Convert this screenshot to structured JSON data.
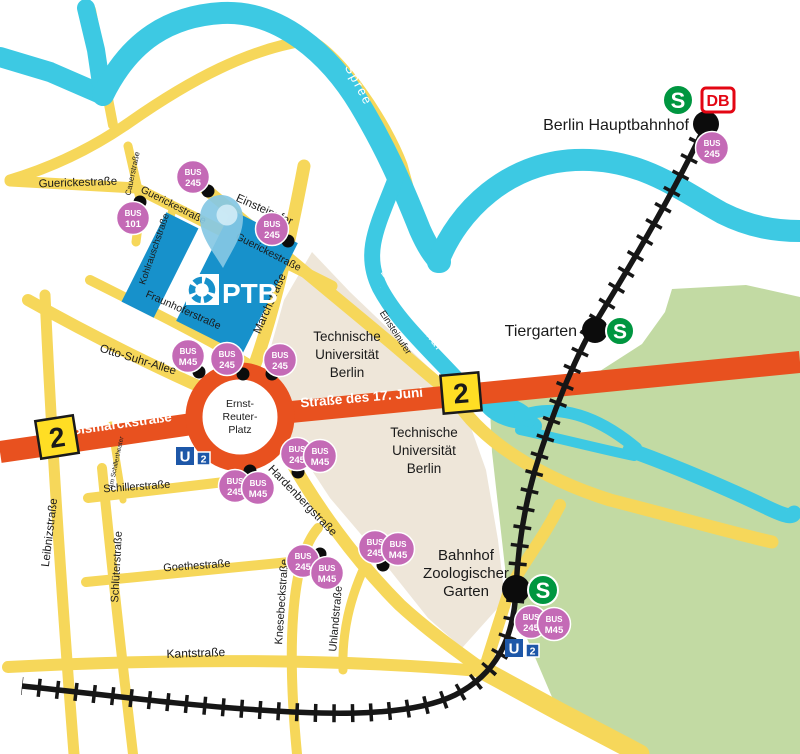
{
  "map_title": "PTB Berlin Ernst-Reuter-Platz area map",
  "colors": {
    "water": "#3DC9E3",
    "street_yellow": "#F6D75A",
    "u2_road_orange": "#E8511F",
    "park_green": "#C2DAA3",
    "campus_beige": "#EEE6D9",
    "ptb_building_blue": "#1791CB",
    "pin_blue": "#85C8E4",
    "bus_badge_magenta": "#C46AB6",
    "sbahn_green": "#009640",
    "ubahn_blue": "#1D57A8",
    "db_red": "#E30613",
    "road_badge_yellow": "#FFDE24",
    "railway_black": "#161616"
  },
  "streets": {
    "guericke": "Guerickestraße",
    "cauer": "Cauerstraße",
    "einsteinufer": "Einsteinufer",
    "kohlrausch": "Kohlrauschstraße",
    "fraunhofer": "Fraunhoferstraße",
    "march": "Marchstraße",
    "otto_suhr": "Otto-Suhr-Allee",
    "bismarck": "Bismarckstraße",
    "str17juni": "Straße des 17. Juni",
    "leibniz": "Leibnizstraße",
    "am_schillertheater": "Am Schillertheater",
    "schiller": "Schillerstraße",
    "schlueter": "Schlüterstraße",
    "goethe": "Goethestraße",
    "knesebeck": "Knesebeckstraße",
    "uhland": "Uhlandstraße",
    "kant": "Kantstraße",
    "hardenberg": "Hardenbergstraße"
  },
  "water": {
    "spree": "Spree",
    "landwehrkanal": "Landwehrkanal"
  },
  "areas": {
    "tu_line1": "Technische",
    "tu_line2": "Universität",
    "tu_line3": "Berlin"
  },
  "places": {
    "erp_line1": "Ernst-",
    "erp_line2": "Reuter-",
    "erp_line3": "Platz",
    "hauptbahnhof": "Berlin Hauptbahnhof",
    "tiergarten": "Tiergarten",
    "zoo_line1": "Bahnhof",
    "zoo_line2": "Zoologischer",
    "zoo_line3": "Garten",
    "ptb": "PTB"
  },
  "transit": {
    "sbahn": "S",
    "ubahn": "U",
    "u2_number": "2",
    "db": "DB",
    "road_badge_2": "2",
    "bus": "BUS",
    "route_245": "245",
    "route_m45": "M45",
    "route_101": "101"
  },
  "bus_stops": [
    {
      "line": "BUS",
      "route": "245"
    },
    {
      "line": "BUS",
      "route": "101"
    },
    {
      "line": "BUS",
      "route": "245"
    },
    {
      "line": "BUS",
      "route": "M45"
    },
    {
      "line": "BUS",
      "route": "245"
    },
    {
      "line": "BUS",
      "route": "245"
    },
    {
      "line": "BUS",
      "route": "245"
    },
    {
      "line": "BUS",
      "route": "M45"
    },
    {
      "line": "BUS",
      "route": "245"
    },
    {
      "line": "BUS",
      "route": "M45"
    },
    {
      "line": "BUS",
      "route": "245"
    },
    {
      "line": "BUS",
      "route": "M45"
    },
    {
      "line": "BUS",
      "route": "245"
    },
    {
      "line": "BUS",
      "route": "M45"
    },
    {
      "line": "BUS",
      "route": "245"
    },
    {
      "line": "BUS",
      "route": "M45"
    },
    {
      "line": "BUS",
      "route": "245"
    }
  ]
}
